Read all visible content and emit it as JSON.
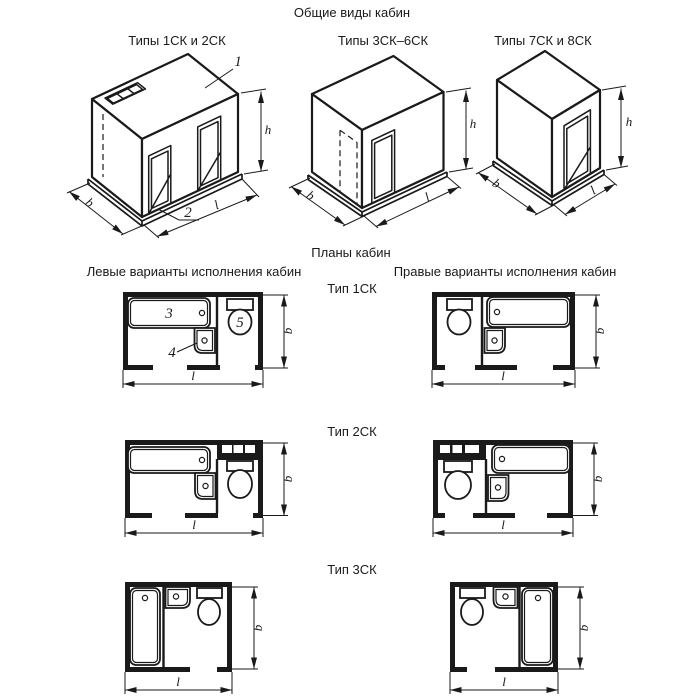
{
  "titles": {
    "general_views": "Общие виды кабин",
    "plans": "Планы кабин"
  },
  "iso_views": [
    {
      "label": "Типы 1СК и 2СК"
    },
    {
      "label": "Типы 3СК–6СК"
    },
    {
      "label": "Типы 7СК и 8СК"
    }
  ],
  "plan_columns": {
    "left": "Левые варианты исполнения кабин",
    "right": "Правые варианты исполнения кабин"
  },
  "plan_types": {
    "type1": "Тип 1СК",
    "type2": "Тип 2СК",
    "type3": "Тип 3СК"
  },
  "dim_labels": {
    "width": "b",
    "length": "l",
    "height": "h"
  },
  "part_callouts": {
    "c1": "1",
    "c2": "2",
    "c3": "3",
    "c4": "4",
    "c5": "5"
  }
}
